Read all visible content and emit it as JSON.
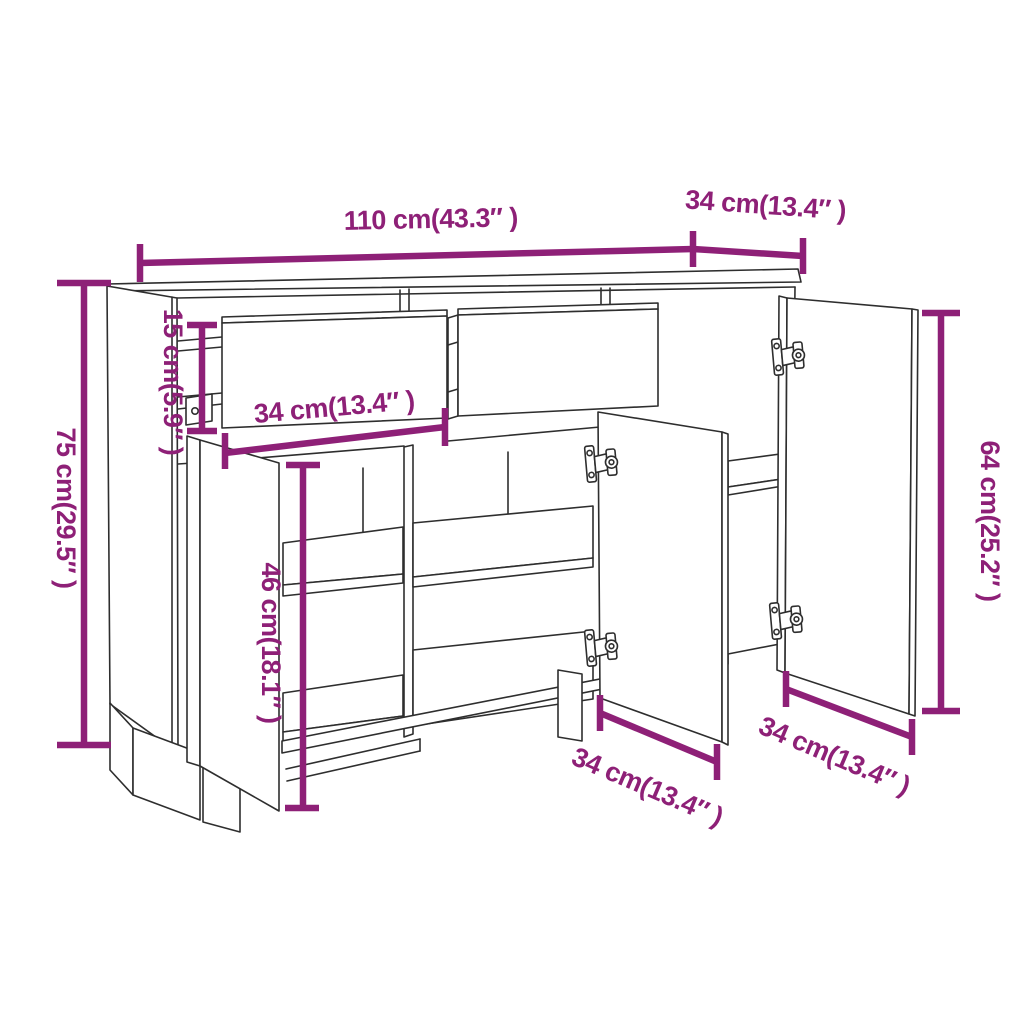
{
  "page": {
    "background": "#ffffff"
  },
  "diagram": {
    "subject": "sideboard dimension diagram",
    "style": {
      "dimension_color": "#8E2077",
      "outline_color": "#2E2E2E",
      "background": "#FFFFFF"
    },
    "labels": {
      "overall_width": "110 cm(43.3″ )",
      "overall_depth": "34 cm(13.4″ )",
      "overall_height": "75 cm(29.5″ )",
      "drawer_height": "15 cm(5.9″ )",
      "drawer_width": "34 cm(13.4″ )",
      "interior_height": "46 cm(18.1″ )",
      "door_height": "64 cm(25.2″ )",
      "middle_door_width": "34 cm(13.4″ )",
      "right_door_width": "34 cm(13.4″ )"
    }
  }
}
